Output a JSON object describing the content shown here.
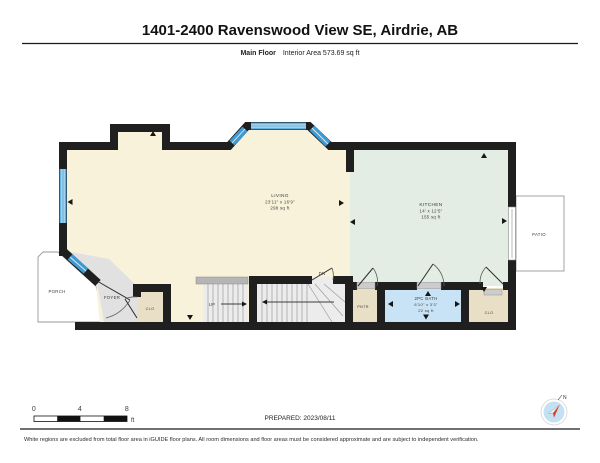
{
  "header": {
    "title": "1401-2400 Ravenswood View SE, Airdrie, AB",
    "floor_label": "Main Floor",
    "area_label": "Interior Area 573.69 sq ft"
  },
  "rooms": {
    "living": {
      "name": "LIVING",
      "dims": "23'11\" x 16'9\"",
      "area": "298 sq ft"
    },
    "kitchen": {
      "name": "KITCHEN",
      "dims": "14' x 12'5\"",
      "area": "155 sq ft"
    },
    "bath": {
      "name": "2PC BATH",
      "dims": "6'10\" x 3'3\"",
      "area": "22 sq ft"
    },
    "foyer": {
      "name": "FOYER"
    },
    "closet_foyer": {
      "name": "CLO"
    },
    "pantry": {
      "name": "PNTR"
    },
    "closet_kitchen": {
      "name": "CLO"
    },
    "porch": {
      "name": "PORCH"
    },
    "patio": {
      "name": "PATIO"
    }
  },
  "stairs": {
    "up_label": "UP",
    "down_label": "DN"
  },
  "scale_bar": {
    "ticks": [
      "0",
      "4",
      "8"
    ],
    "unit": "ft"
  },
  "compass": {
    "north_label": "N"
  },
  "footer": {
    "prepared": "PREPARED: 2023/08/11",
    "disclaimer": "White regions are excluded from total floor area in iGUIDE floor plans. All room dimensions and floor areas must be considered approximate and are subject to independent verification."
  },
  "colors": {
    "wall": "#1f1f1f",
    "window": "#3f9ad2",
    "living": "#f9f2da",
    "kitchen": "#e3ede4",
    "bath": "#c8e3f5",
    "closet": "#e9dfc7",
    "foyer": "#e1e1e1",
    "stairs": "#ececec"
  }
}
